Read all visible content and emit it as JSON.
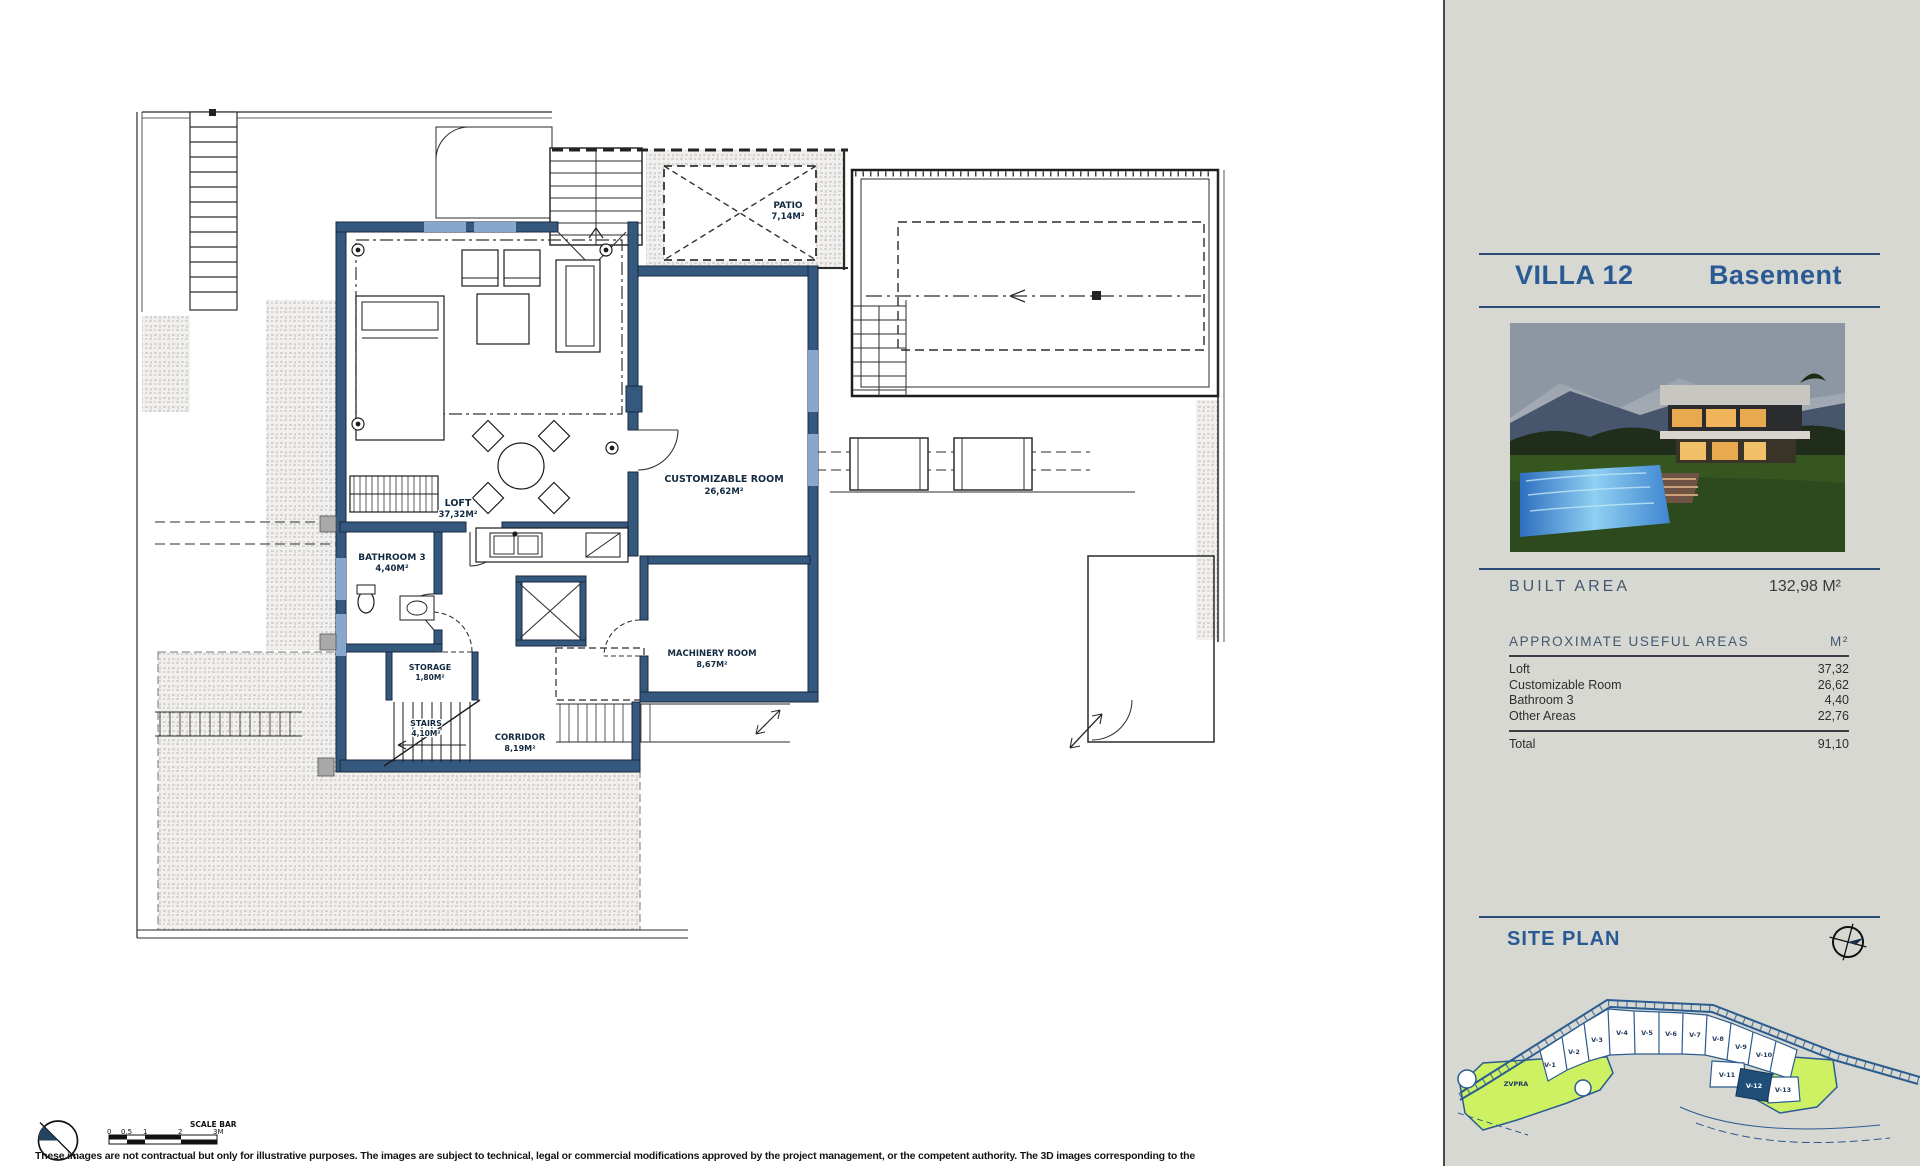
{
  "page": {
    "disclaimer": "These images are not contractual but only for illustrative purposes. The images are subject to technical, legal or commercial modifications approved by the project management, or the competent authority. The 3D images corresponding to the"
  },
  "sidebar": {
    "title_villa": "VILLA 12",
    "title_floor": "Basement",
    "built_area": {
      "label": "BUILT AREA",
      "value": "132,98 M²"
    },
    "areas": {
      "heading": "APPROXIMATE USEFUL AREAS",
      "unit": "M²",
      "rows": [
        {
          "label": "Loft",
          "value": "37,32"
        },
        {
          "label": "Customizable Room",
          "value": "26,62"
        },
        {
          "label": "Bathroom 3",
          "value": "4,40"
        },
        {
          "label": "Other Areas",
          "value": "22,76"
        }
      ],
      "total_label": "Total",
      "total_value": "91,10"
    },
    "site_plan": {
      "heading": "SITE PLAN",
      "zone_label": "ZVPRA",
      "plots": [
        "V-1",
        "V-2",
        "V-3",
        "V-4",
        "V-5",
        "V-6",
        "V-7",
        "V-8",
        "V-9",
        "V-10",
        "V-11",
        "V-12",
        "V-13"
      ],
      "highlighted_plot": "V-12"
    }
  },
  "plan": {
    "rooms": [
      {
        "name": "PATIO",
        "area": "7,14M²"
      },
      {
        "name": "LOFT",
        "area": "37,32M²"
      },
      {
        "name": "CUSTOMIZABLE ROOM",
        "area": "26,62M²"
      },
      {
        "name": "BATHROOM 3",
        "area": "4,40M²"
      },
      {
        "name": "STORAGE",
        "area": "1,80M²"
      },
      {
        "name": "STAIRS",
        "area": "4,10M²"
      },
      {
        "name": "CORRIDOR",
        "area": "8,19M²"
      },
      {
        "name": "MACHINERY ROOM",
        "area": "8,67M²"
      }
    ],
    "scale_bar": {
      "label": "SCALE BAR",
      "ticks": [
        "0",
        "0.5",
        "1",
        "2",
        "3M"
      ]
    }
  },
  "colors": {
    "accent_blue": "#2a5a94",
    "wall_blue": "#35587e",
    "site_green": "#cdf163",
    "sidebar_bg": "#d8d8d3"
  }
}
